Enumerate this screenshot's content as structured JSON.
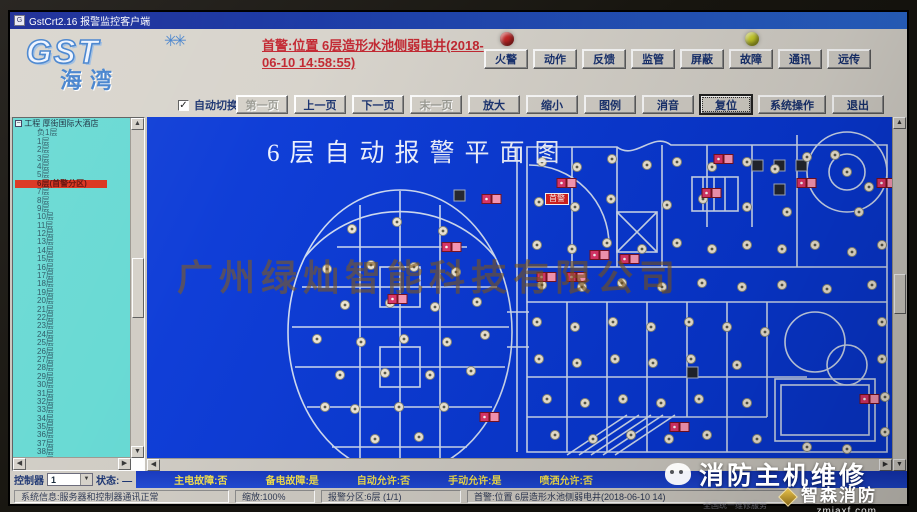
{
  "window": {
    "title": "GstCrt2.16 报警监控客户端"
  },
  "header": {
    "logo_main": "GST",
    "logo_spark": "✳✳",
    "logo_sub": "海湾",
    "alarm_text": "首警:位置 6层造形水池侧弱电井(2018-06-10 14:58:55)",
    "lamp_red_color": "#c42222",
    "lamp_yellow_color": "#cdd229",
    "indicator_buttons": [
      "火警",
      "动作",
      "反馈",
      "监管",
      "屏蔽",
      "故障",
      "通讯",
      "远传"
    ]
  },
  "toolbar": {
    "auto_switch_label": "自动切换",
    "auto_switch_checked": "✓",
    "buttons": [
      {
        "label": "第一页",
        "disabled": true
      },
      {
        "label": "上一页",
        "disabled": false
      },
      {
        "label": "下一页",
        "disabled": false
      },
      {
        "label": "末一页",
        "disabled": true
      },
      {
        "label": "放大",
        "disabled": false
      },
      {
        "label": "缩小",
        "disabled": false
      },
      {
        "label": "图例",
        "disabled": false
      },
      {
        "label": "消音",
        "disabled": false
      },
      {
        "label": "复位",
        "disabled": false,
        "focused": true
      },
      {
        "label": "系统操作",
        "disabled": false,
        "wide": true
      },
      {
        "label": "退出",
        "disabled": false
      }
    ]
  },
  "sidebar": {
    "root": "工程 厚街国际大酒店",
    "alarm_index": 6,
    "floors": [
      "负1层",
      "1层",
      "2层",
      "3层",
      "4层",
      "5层",
      "6层(首警分区)",
      "7层",
      "8层",
      "9层",
      "10层",
      "11层",
      "12层",
      "13层",
      "14层",
      "15层",
      "16层",
      "17层",
      "18层",
      "19层",
      "20层",
      "21层",
      "22层",
      "23层",
      "24层",
      "25层",
      "26层",
      "27层",
      "28层",
      "29层",
      "30层",
      "31层",
      "32层",
      "33层",
      "34层",
      "35层",
      "36层",
      "37层",
      "38层",
      "39层"
    ]
  },
  "map": {
    "title": "6层自动报警平面图",
    "watermark": "广州绿灿智能科技有限公司",
    "first_alarm_badge": "首警",
    "bg_color": "#0838d6",
    "wall_color": "#dce6f6",
    "detectors": [
      [
        205,
        112
      ],
      [
        250,
        105
      ],
      [
        296,
        114
      ],
      [
        180,
        152
      ],
      [
        224,
        148
      ],
      [
        267,
        150
      ],
      [
        309,
        155
      ],
      [
        198,
        188
      ],
      [
        243,
        186
      ],
      [
        288,
        190
      ],
      [
        330,
        185
      ],
      [
        170,
        222
      ],
      [
        214,
        225
      ],
      [
        257,
        222
      ],
      [
        300,
        225
      ],
      [
        338,
        218
      ],
      [
        193,
        258
      ],
      [
        238,
        256
      ],
      [
        283,
        258
      ],
      [
        324,
        254
      ],
      [
        208,
        292
      ],
      [
        252,
        290
      ],
      [
        297,
        290
      ],
      [
        178,
        290
      ],
      [
        228,
        322
      ],
      [
        272,
        320
      ],
      [
        395,
        45
      ],
      [
        430,
        50
      ],
      [
        465,
        42
      ],
      [
        500,
        48
      ],
      [
        530,
        45
      ],
      [
        565,
        50
      ],
      [
        600,
        45
      ],
      [
        628,
        52
      ],
      [
        660,
        40
      ],
      [
        700,
        55
      ],
      [
        722,
        70
      ],
      [
        688,
        38
      ],
      [
        392,
        85
      ],
      [
        428,
        90
      ],
      [
        464,
        82
      ],
      [
        520,
        88
      ],
      [
        556,
        82
      ],
      [
        600,
        90
      ],
      [
        640,
        95
      ],
      [
        712,
        95
      ],
      [
        390,
        128
      ],
      [
        425,
        132
      ],
      [
        460,
        126
      ],
      [
        495,
        132
      ],
      [
        530,
        126
      ],
      [
        565,
        132
      ],
      [
        600,
        128
      ],
      [
        635,
        132
      ],
      [
        668,
        128
      ],
      [
        705,
        135
      ],
      [
        735,
        128
      ],
      [
        395,
        168
      ],
      [
        435,
        170
      ],
      [
        475,
        166
      ],
      [
        515,
        170
      ],
      [
        555,
        166
      ],
      [
        595,
        170
      ],
      [
        635,
        168
      ],
      [
        680,
        172
      ],
      [
        725,
        168
      ],
      [
        390,
        205
      ],
      [
        428,
        210
      ],
      [
        466,
        205
      ],
      [
        504,
        210
      ],
      [
        542,
        205
      ],
      [
        580,
        210
      ],
      [
        618,
        215
      ],
      [
        735,
        205
      ],
      [
        392,
        242
      ],
      [
        430,
        246
      ],
      [
        468,
        242
      ],
      [
        506,
        246
      ],
      [
        544,
        242
      ],
      [
        590,
        248
      ],
      [
        735,
        242
      ],
      [
        400,
        282
      ],
      [
        438,
        286
      ],
      [
        476,
        282
      ],
      [
        514,
        286
      ],
      [
        552,
        282
      ],
      [
        600,
        286
      ],
      [
        408,
        318
      ],
      [
        446,
        322
      ],
      [
        484,
        318
      ],
      [
        522,
        322
      ],
      [
        560,
        318
      ],
      [
        610,
        322
      ],
      [
        660,
        330
      ],
      [
        700,
        332
      ],
      [
        738,
        315
      ],
      [
        738,
        280
      ]
    ],
    "alarms": [
      [
        340,
        82
      ],
      [
        415,
        66
      ],
      [
        448,
        138
      ],
      [
        478,
        142
      ],
      [
        560,
        76
      ],
      [
        572,
        42
      ],
      [
        655,
        66
      ],
      [
        735,
        66
      ],
      [
        395,
        160
      ],
      [
        425,
        160
      ],
      [
        246,
        182
      ],
      [
        338,
        300
      ],
      [
        528,
        310
      ],
      [
        718,
        282
      ],
      [
        300,
        130
      ]
    ],
    "dark_units": [
      [
        610,
        48
      ],
      [
        632,
        48
      ],
      [
        654,
        48
      ],
      [
        632,
        72
      ],
      [
        312,
        78
      ],
      [
        545,
        255
      ]
    ]
  },
  "status1": {
    "controller_label": "控制器",
    "controller_value": "1",
    "state": "状态: —",
    "main_power": "主电故障:否",
    "backup_power": "备电故障:是",
    "auto_allow": "自动允许:否",
    "manual_allow": "手动允许:是",
    "spray_allow": "喷洒允许:否"
  },
  "status2": {
    "system_info": "系统信息:服务器和控制器通讯正常",
    "zoom": "缩放:100%",
    "alarm_zone": "报警分区:6层 (1/1)",
    "first_alarm": "首警:位置 6层造形水池侧弱电井(2018-06-10 14)"
  },
  "overlay": {
    "service_title": "消防主机维修",
    "brand": "智森消防",
    "site": "zmjaxf.com",
    "fine_print": "全国统一维修服务"
  }
}
